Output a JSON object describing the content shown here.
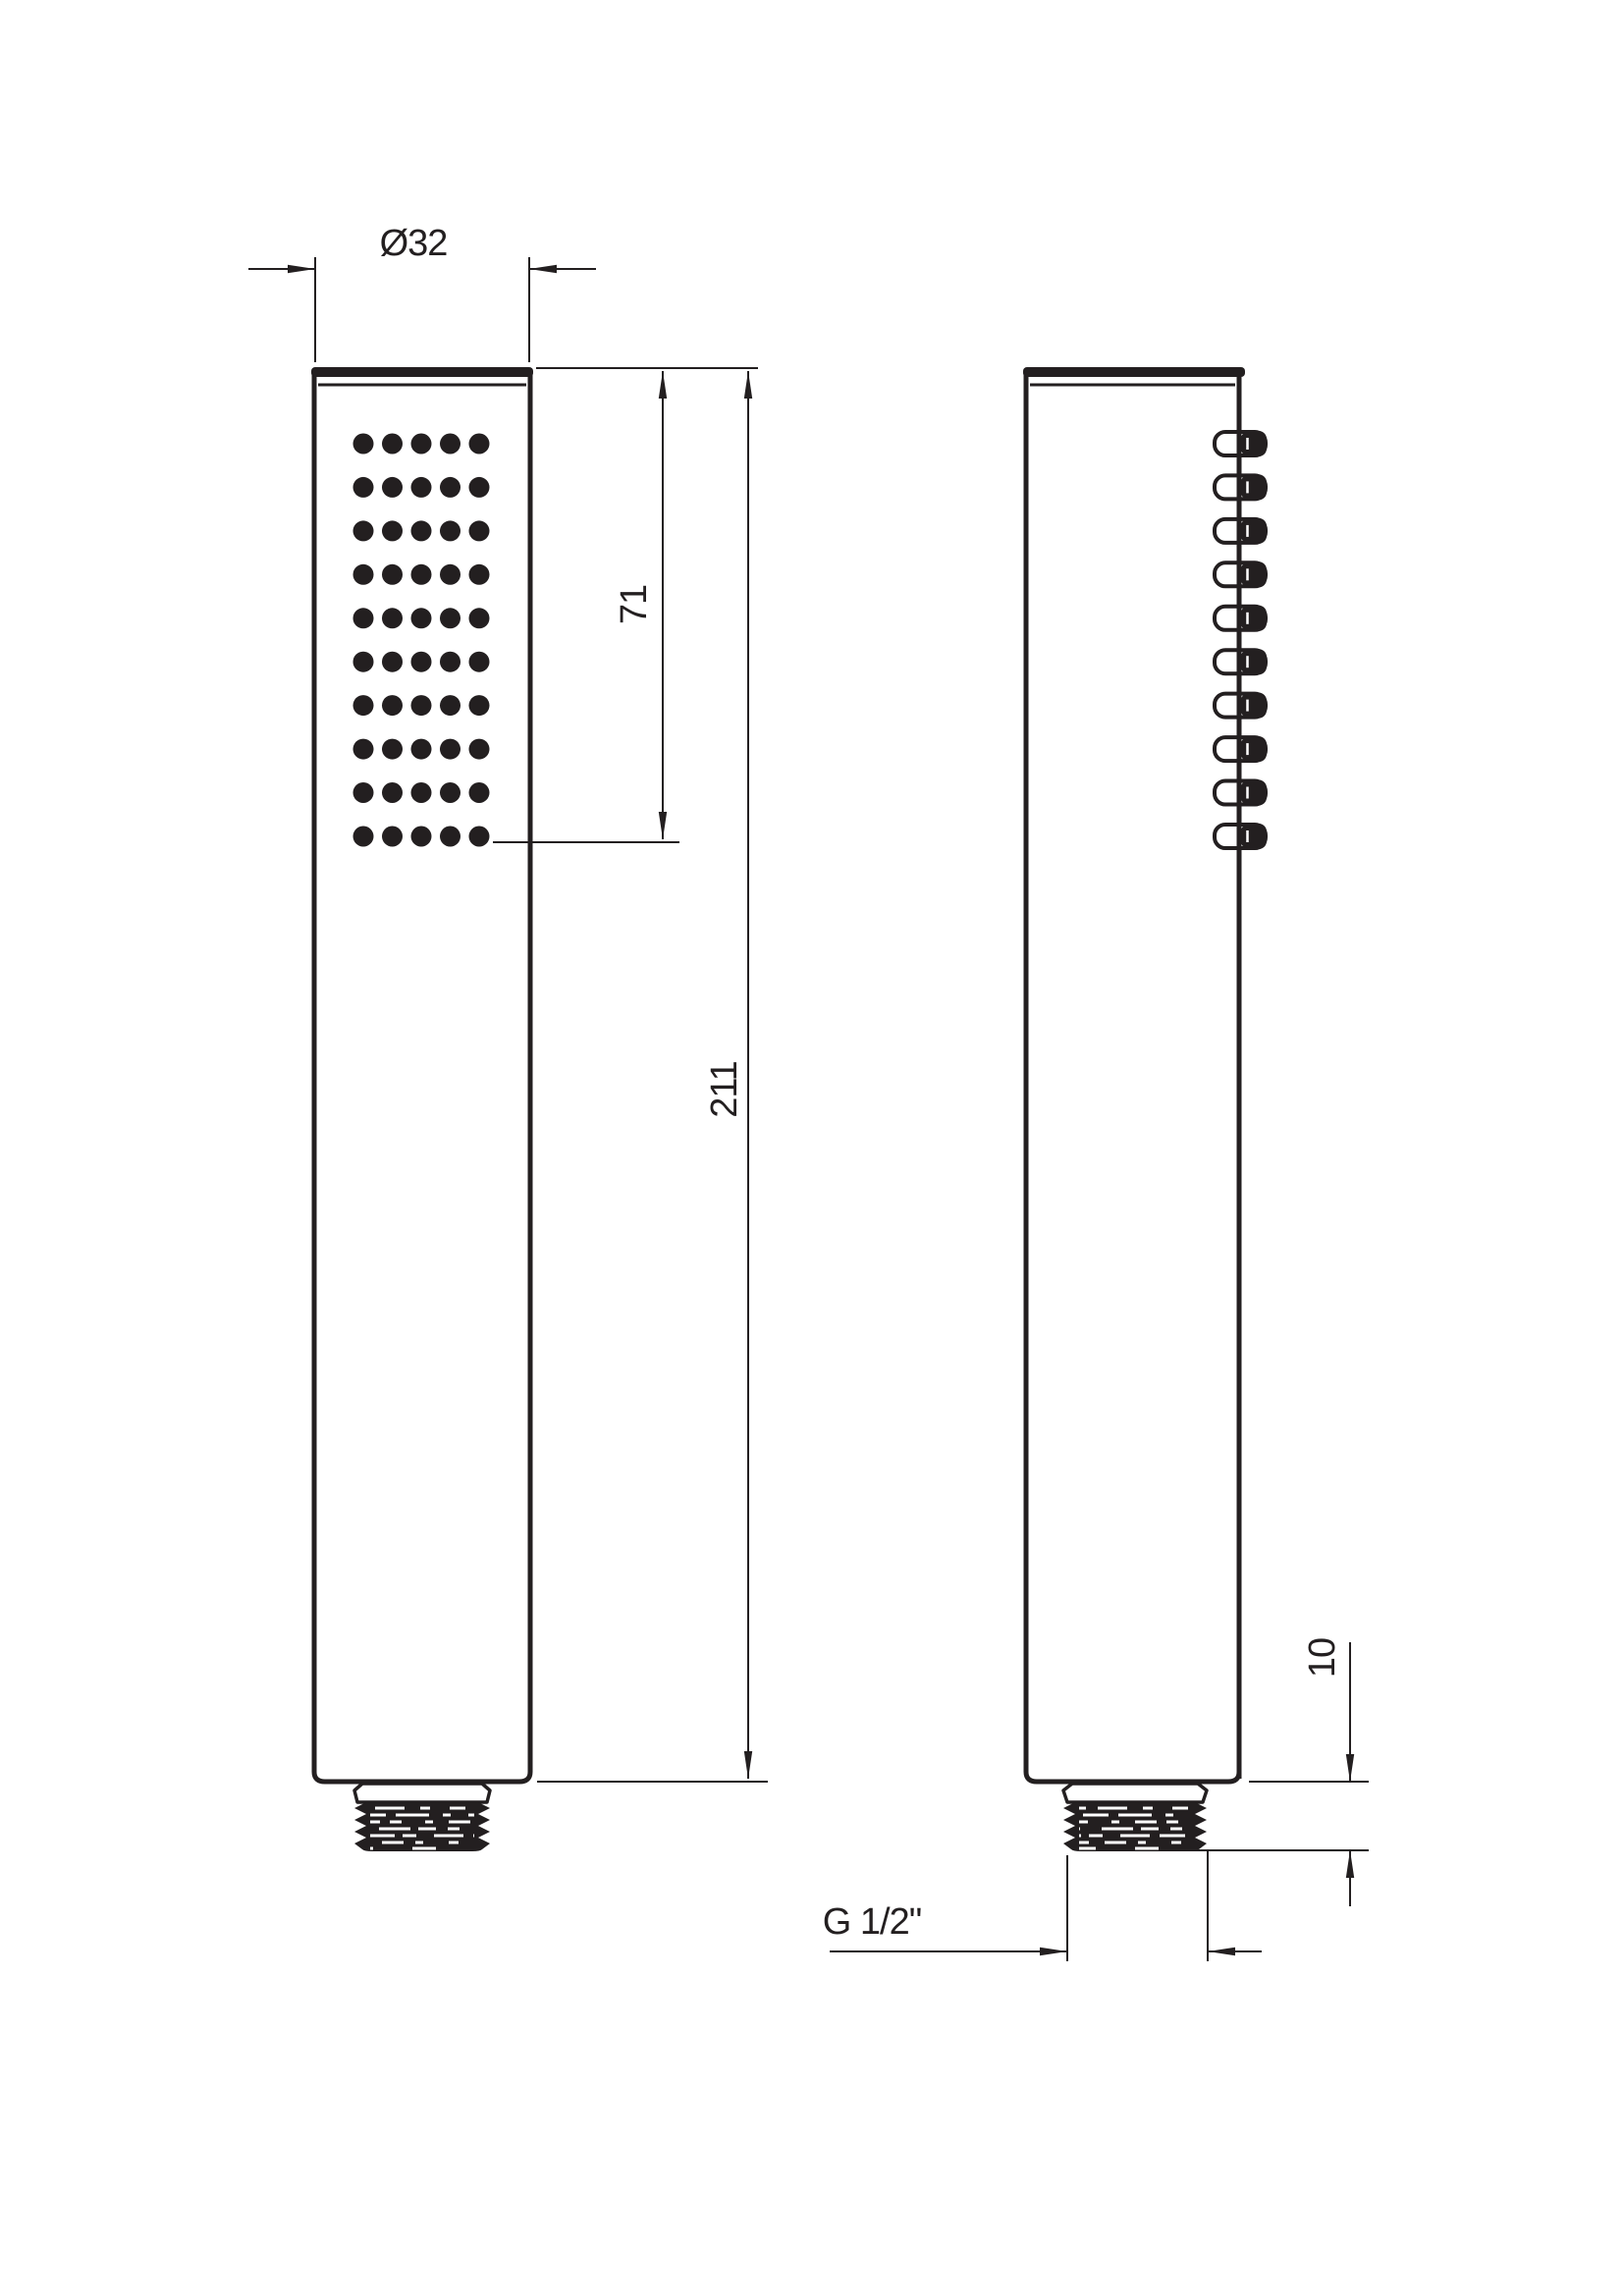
{
  "colors": {
    "ink": "#231f20",
    "paper": "#ffffff"
  },
  "views": {
    "front": {
      "dot_rows": 10,
      "dot_cols": 5
    },
    "side": {
      "nozzle_count": 10
    }
  },
  "dimensions": {
    "diameter": "Ø32",
    "spray_face_length": "71",
    "overall_length": "211",
    "thread_length": "10",
    "thread_spec": "G 1/2\""
  }
}
